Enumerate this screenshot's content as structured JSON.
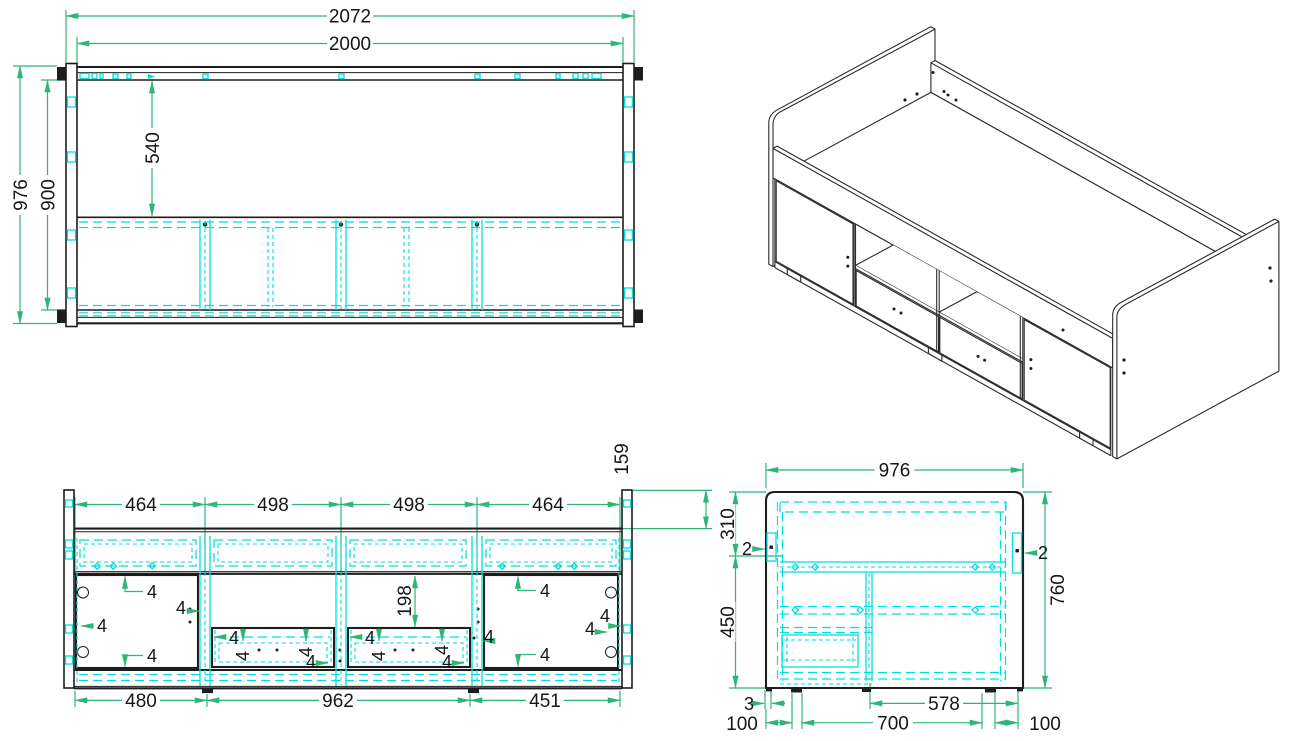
{
  "drawing": {
    "type": "furniture-assembly-technical-drawing",
    "subject": "cabin storage bed - four views (plan, isometric, front elevation, side elevation)",
    "colors": {
      "dimension_lines": "#2fb576",
      "hidden_lines": "#00dede",
      "outlines": "#1d1d1d",
      "background": "#ffffff"
    },
    "top_view": {
      "overall_width": "2072",
      "inner_width": "2000",
      "overall_depth": "976",
      "inner_depth": "900",
      "deck_depth": "540"
    },
    "front_view": {
      "section_1": "464",
      "section_2": "498",
      "section_3": "498",
      "section_4": "464",
      "rail_height": "159",
      "opening_height": "198",
      "bottom_1": "480",
      "bottom_2": "962",
      "bottom_3": "451",
      "gap": "4"
    },
    "side_view": {
      "width": "976",
      "upper_offset": "310",
      "lower_offset": "450",
      "height": "760",
      "connector": "2",
      "base_gap": "3",
      "left_inset": "100",
      "foot_span": "700",
      "clearance": "578",
      "right_inset": "100"
    }
  }
}
